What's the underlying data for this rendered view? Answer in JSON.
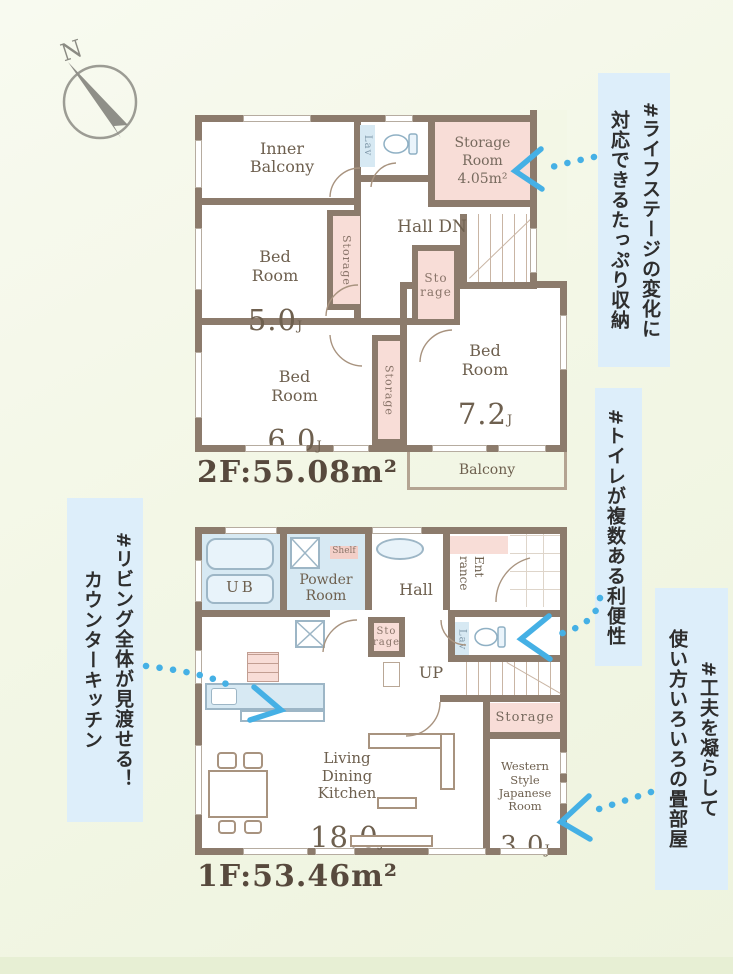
{
  "colors": {
    "background": "#f3f7e6",
    "wall": "#8c7b6c",
    "storage_pink": "#f8ddd7",
    "fixture_blue": "#d7e9f3",
    "note_background": "#ddeefa",
    "arrow_blue": "#45b0e5",
    "plan_text": "#6e604f"
  },
  "compass": {
    "north": "N"
  },
  "floor2": {
    "area_label": "2F:55.08m²",
    "inner_balcony": "Inner\nBalcony",
    "lav": "Lav",
    "storage_room": "Storage\nRoom\n4.05m²",
    "hall": "Hall  DN",
    "closet_left": "Storage",
    "closet_mid": "Sto\nrage",
    "closet_bottom": "Storage",
    "bed5": {
      "name": "Bed\nRoom",
      "size": "5.0",
      "unit": "J"
    },
    "bed6": {
      "name": "Bed\nRoom",
      "size": "6.0",
      "unit": "J"
    },
    "bed7": {
      "name": "Bed\nRoom",
      "size": "7.2",
      "unit": "J"
    },
    "balcony": "Balcony"
  },
  "floor1": {
    "area_label": "1F:53.46m²",
    "ub": "UB",
    "shelf": "Shelf",
    "powder": "Powder\nRoom",
    "hall": "Hall",
    "entrance": "Ent\nrance",
    "closet_hall": "Sto\nrage",
    "lav": "Lav",
    "up": "UP",
    "ldk": {
      "name": "Living\nDining\nKitchen",
      "size": "18.0",
      "unit": "J"
    },
    "storage": "Storage",
    "japanese_room": {
      "name": "Western\nStyle\nJapanese\nRoom",
      "size": "3.0",
      "unit": "J"
    }
  },
  "annotations": {
    "storage_note": "#ライフステージの変化に\n対応できるたっぷり収納",
    "toilet_note": "#トイレが複数ある利便性",
    "tatami_note": "#工夫を凝らして\n使い方いろいろの畳部屋",
    "kitchen_note": "#リビング全体が見渡せる！\nカウンターキッチン"
  }
}
